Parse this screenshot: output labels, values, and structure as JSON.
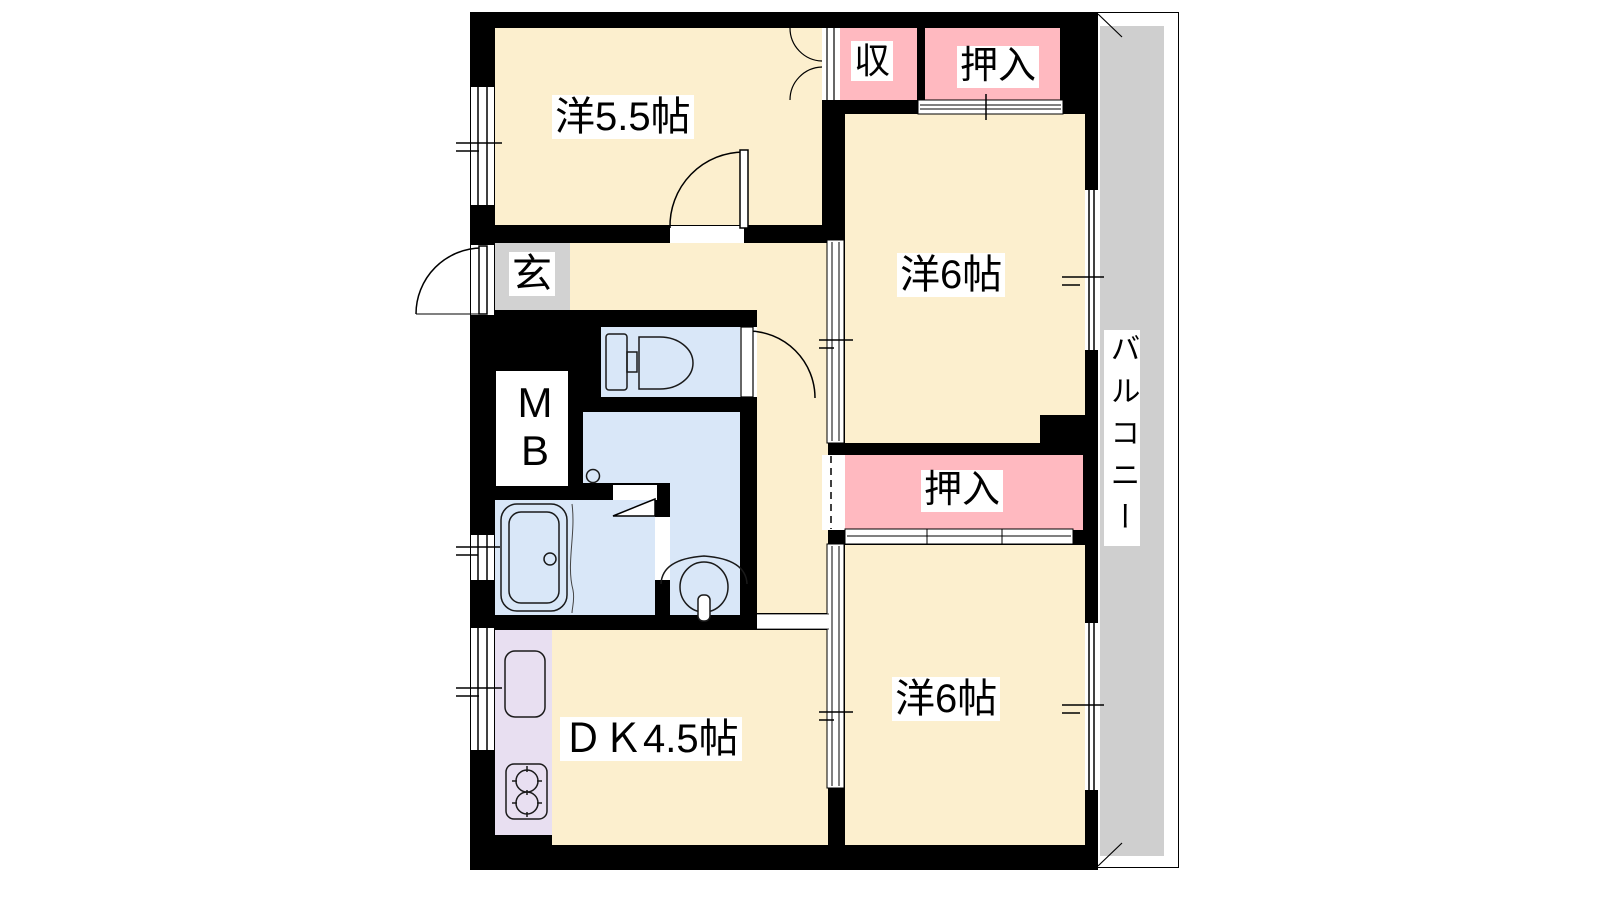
{
  "floorplan": {
    "rooms": {
      "western_5_5": "洋5.5帖",
      "storage": "収",
      "closet_upper": "押入",
      "western_6_upper": "洋6帖",
      "entrance": "玄",
      "meter_box": "MB",
      "closet_middle": "押入",
      "western_6_lower": "洋6帖",
      "dining_kitchen": "ＤＫ4.5帖",
      "balcony": "バルコニー"
    },
    "colors": {
      "room_floor": "#FCEFCE",
      "closet": "#FFB9C0",
      "wet_area": "#D9E7F8",
      "kitchen_counter": "#E8DFF1",
      "balcony": "#CFCFCF",
      "entrance": "#D2D2D2",
      "wall": "#000000"
    }
  }
}
